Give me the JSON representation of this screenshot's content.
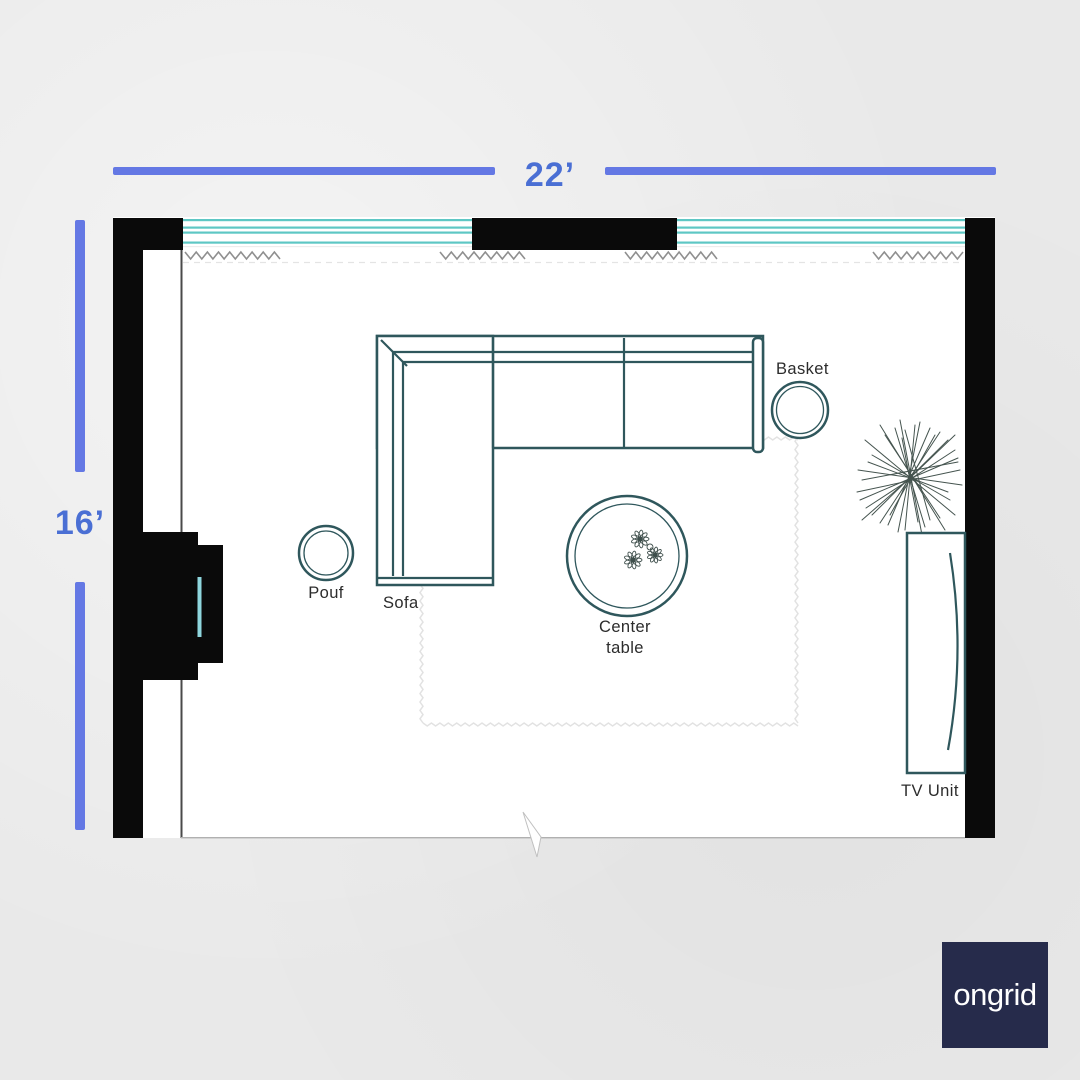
{
  "dimensions": {
    "width_label": "22’",
    "height_label": "16’"
  },
  "furniture": {
    "sofa": "Sofa",
    "pouf": "Pouf",
    "center_table": "Center table",
    "basket": "Basket",
    "tv_unit": "TV Unit"
  },
  "logo": {
    "text": "ongrid"
  },
  "colors": {
    "bg": "#e9e9e9",
    "room": "#ffffff",
    "wall": "#0a0a0a",
    "dim_line": "#6478e4",
    "dim_text": "#4a6fd4",
    "window_teal": "#5ec7c4",
    "fireplace_accent": "#8fd6dd",
    "furniture": "#2f575c",
    "plant": "#45544f",
    "curtain": "#8f8f8f",
    "rug": "#e2e2e2",
    "label": "#2c2c2c",
    "logo_bg": "#262b4b",
    "logo_text": "#ffffff"
  }
}
